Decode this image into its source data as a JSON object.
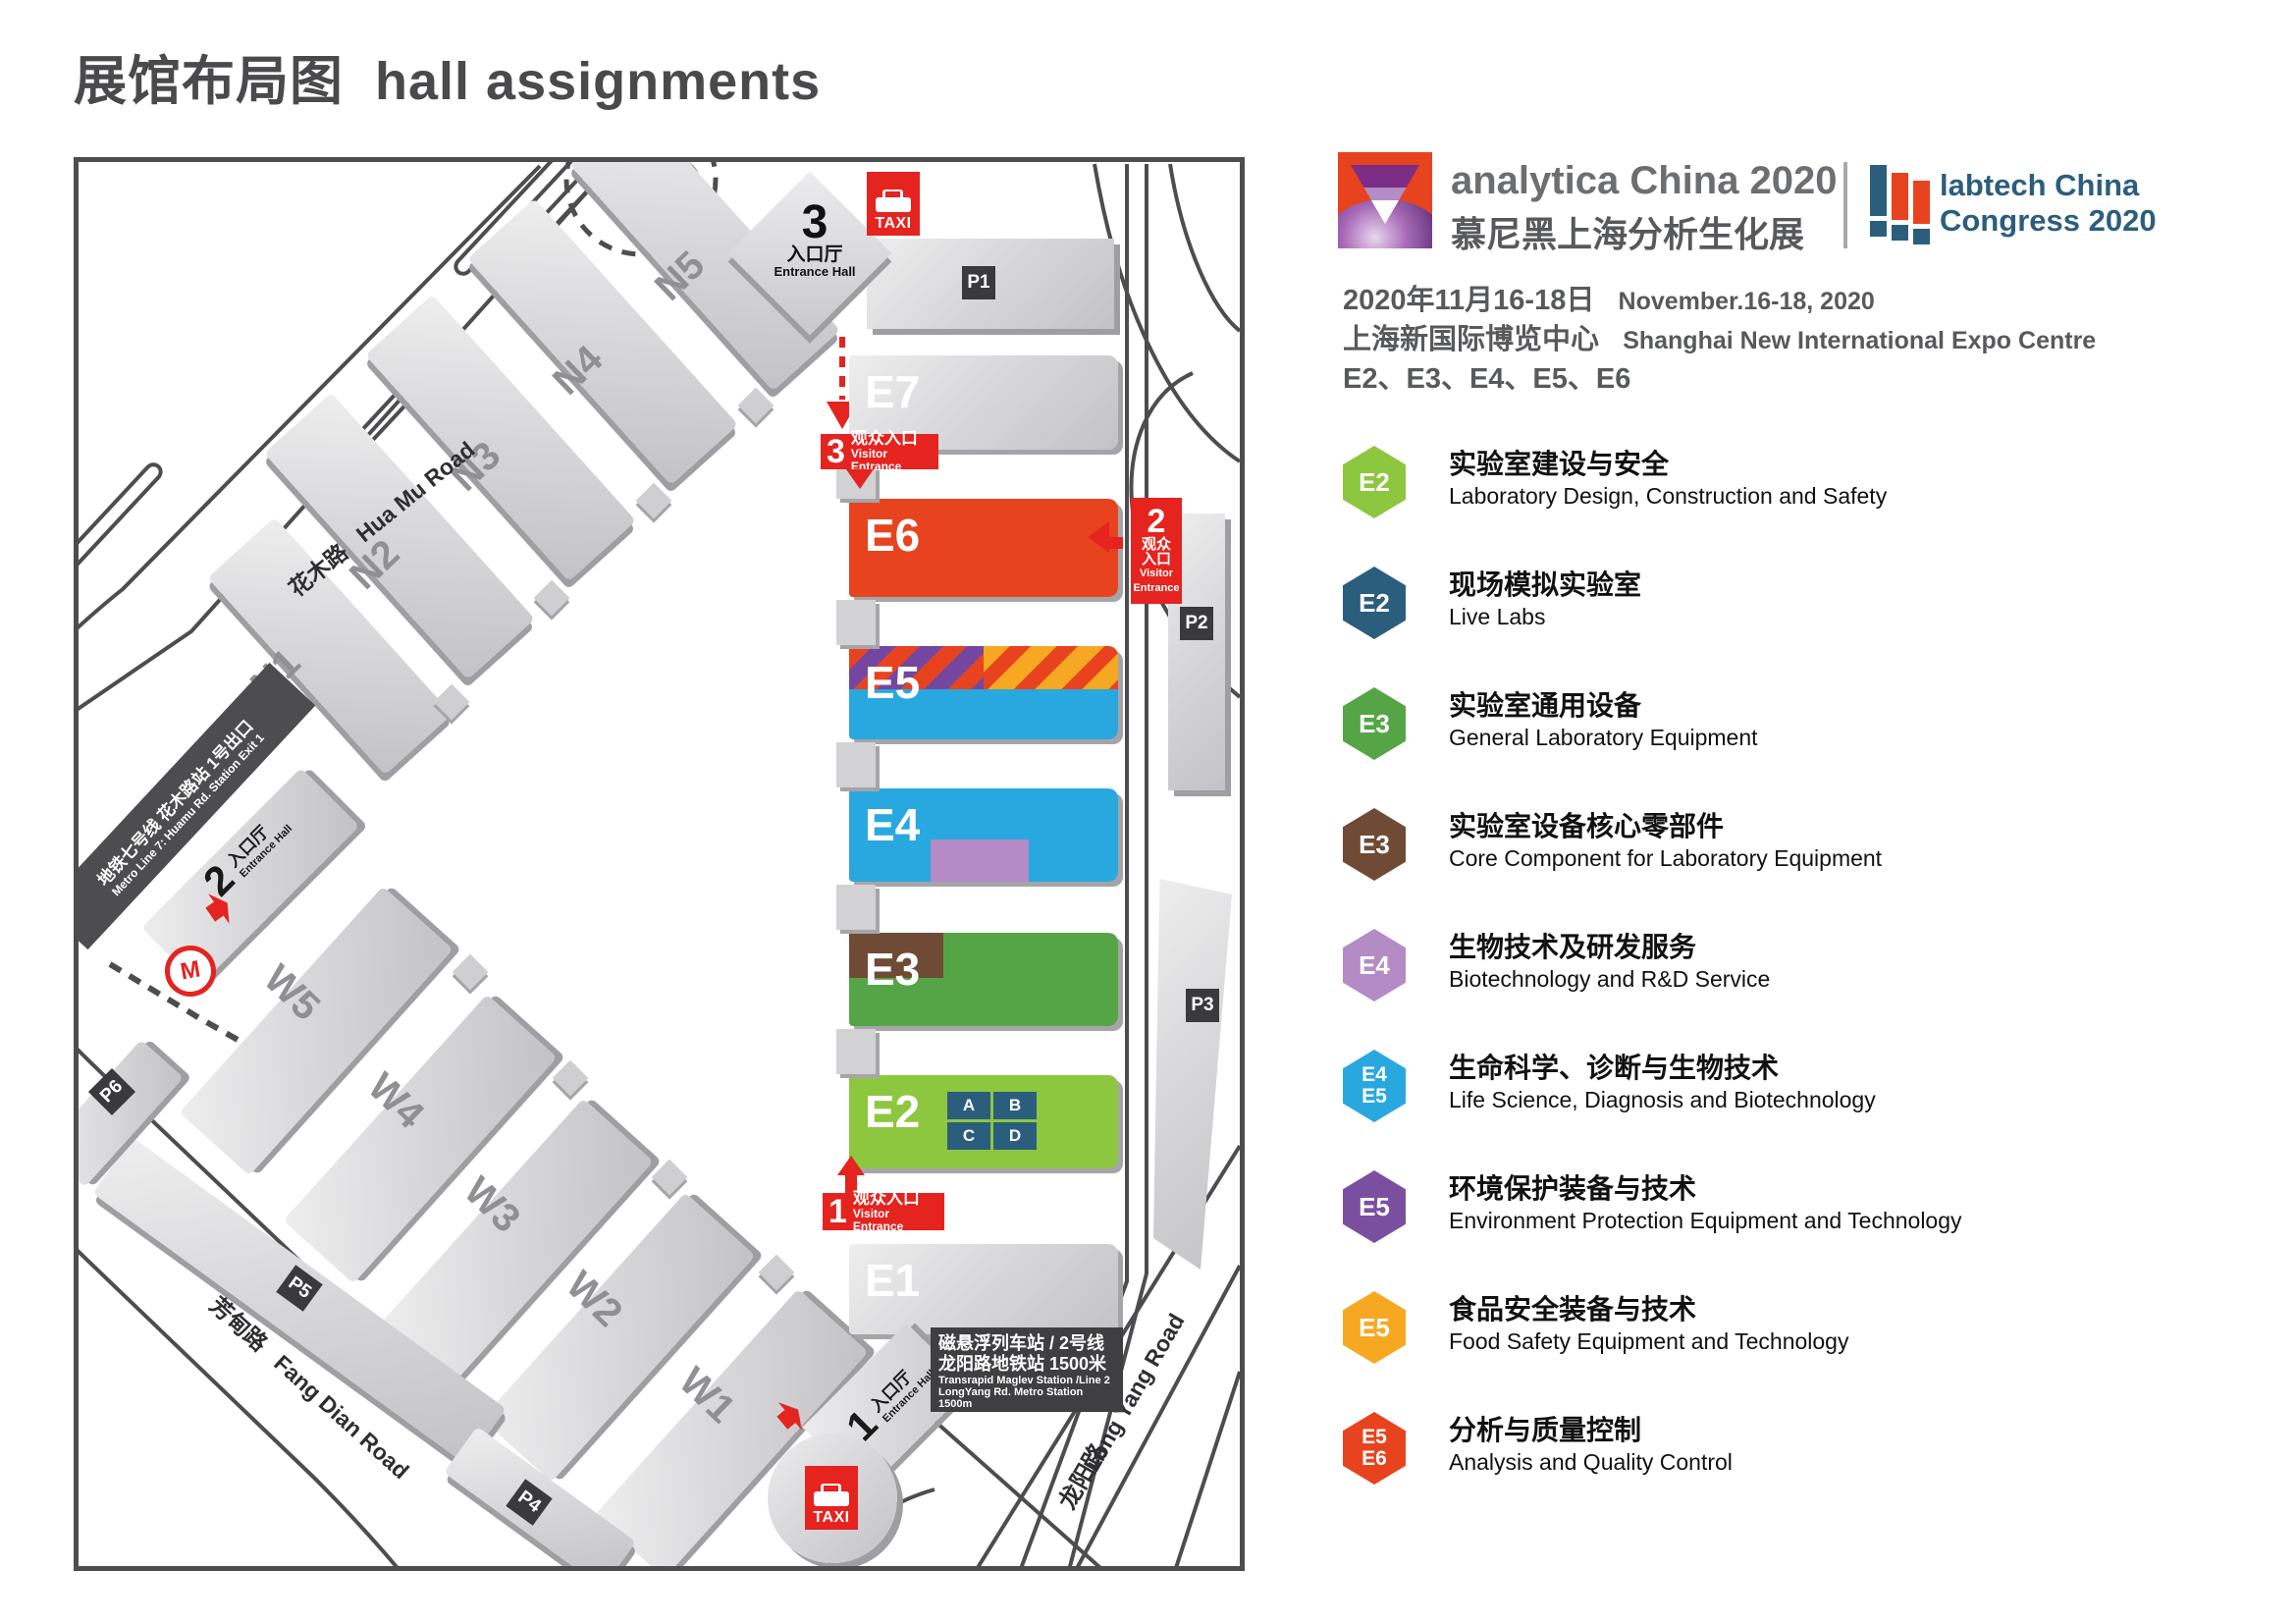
{
  "title": {
    "zh": "展馆布局图",
    "en": "hall assignments"
  },
  "header": {
    "analytica_name": "analytica China 2020",
    "analytica_zh": "慕尼黑上海分析生化展",
    "labtech_line1": "labtech China",
    "labtech_line2": "Congress 2020",
    "date_zh": "2020年11月16-18日",
    "date_en": "November.16-18, 2020",
    "venue_zh": "上海新国际博览中心",
    "venue_en": "Shanghai New International Expo Centre",
    "event_halls": "E2、E3、E4、E5、E6"
  },
  "legend": {
    "items": [
      {
        "badge": "E2",
        "color": "#8dc63f",
        "zh": "实验室建设与安全",
        "en": "Laboratory Design, Construction and Safety"
      },
      {
        "badge": "E2",
        "color": "#2b5e7d",
        "zh": "现场模拟实验室",
        "en": "Live Labs"
      },
      {
        "badge": "E3",
        "color": "#55a546",
        "zh": "实验室通用设备",
        "en": "General Laboratory Equipment"
      },
      {
        "badge": "E3",
        "color": "#6f4b35",
        "zh": "实验室设备核心零部件",
        "en": "Core Component for Laboratory Equipment"
      },
      {
        "badge": "E4",
        "color": "#b58bc6",
        "zh": "生物技术及研发服务",
        "en": "Biotechnology and R&D Service"
      },
      {
        "badge": "E4",
        "badge2": "E5",
        "color": "#29a8e0",
        "zh": "生命科学、诊断与生物技术",
        "en": "Life Science, Diagnosis and Biotechnology"
      },
      {
        "badge": "E5",
        "color": "#7b4fa0",
        "zh": "环境保护装备与技术",
        "en": "Environment Protection Equipment and Technology"
      },
      {
        "badge": "E5",
        "color": "#f7a823",
        "zh": "食品安全装备与技术",
        "en": "Food Safety Equipment and Technology"
      },
      {
        "badge": "E5",
        "badge2": "E6",
        "color": "#e8431f",
        "zh": "分析与质量控制",
        "en": "Analysis and Quality Control"
      }
    ]
  },
  "map": {
    "halls": {
      "e1": "E1",
      "e2": "E2",
      "e3": "E3",
      "e4": "E4",
      "e5": "E5",
      "e6": "E6",
      "e7": "E7",
      "n1": "N1",
      "n2": "N2",
      "n3": "N3",
      "n4": "N4",
      "n5": "N5",
      "w1": "W1",
      "w2": "W2",
      "w3": "W3",
      "w4": "W4",
      "w5": "W5",
      "e2_sections": [
        "A",
        "B",
        "C",
        "D"
      ]
    },
    "parking": {
      "p1": "P1",
      "p2": "P2",
      "p3": "P3",
      "p4": "P4",
      "p5": "P5",
      "p6": "P6"
    },
    "roads": {
      "huamu_zh": "花木路",
      "huamu_en": "Hua Mu Road",
      "fangdian_zh": "芳甸路",
      "fangdian_en": "Fang Dian Road",
      "longyang_zh": "龙阳路",
      "longyang_en": "Long Yang Road"
    },
    "entrance_halls": {
      "zh": "入口厅",
      "en": "Entrance Hall",
      "n1": "1",
      "n2": "2",
      "n3": "3"
    },
    "visitor": {
      "n1": "1",
      "n2": "2",
      "n3": "3",
      "zh": "观众入口",
      "zh1": "观众",
      "zh2": "入口",
      "en": "Visitor Entrance",
      "en1": "Visitor",
      "en2": "Entrance"
    },
    "taxi": "TAXI",
    "metro": {
      "zh": "地铁七号线 花木路站 1号出口",
      "en": "Metro Line 7: Huamu Rd. Station Exit 1"
    },
    "maglev": {
      "zh1": "磁悬浮列车站 / 2号线",
      "zh2": "龙阳路地铁站 1500米",
      "en1": "Transrapid Maglev Station /Line 2",
      "en2": "LongYang Rd. Metro Station 1500m"
    }
  },
  "colors": {
    "badge_red": "#e5231f",
    "e6_red": "#e8431f",
    "blue": "#29a8e0",
    "light_green": "#8dc63f",
    "green": "#55a546",
    "brown": "#6f4b35",
    "light_purple": "#b58bc6",
    "purple": "#7b4fa0",
    "orange": "#f7a823",
    "navy": "#2b5e7d",
    "dark_gray": "#4d4d4f"
  }
}
